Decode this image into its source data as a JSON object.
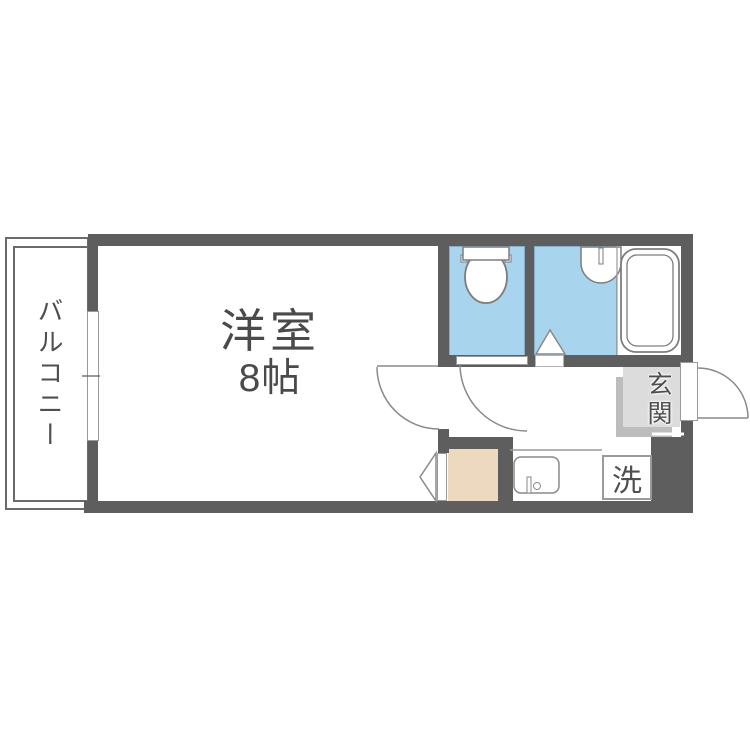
{
  "floorplan": {
    "labels": {
      "balcony": "バルコニー",
      "room": "洋室",
      "room_size": "8帖",
      "entrance": "玄関",
      "laundry": "洗"
    },
    "colors": {
      "wall": "#5e5e5e",
      "wet": "#a8d4ee",
      "beige": "#ecd9bf",
      "genkanFill": "#dcdcdc",
      "genkanShadow": "#bdbdbd",
      "line": "#7d7d7d",
      "text": "#4a4a4a"
    }
  }
}
